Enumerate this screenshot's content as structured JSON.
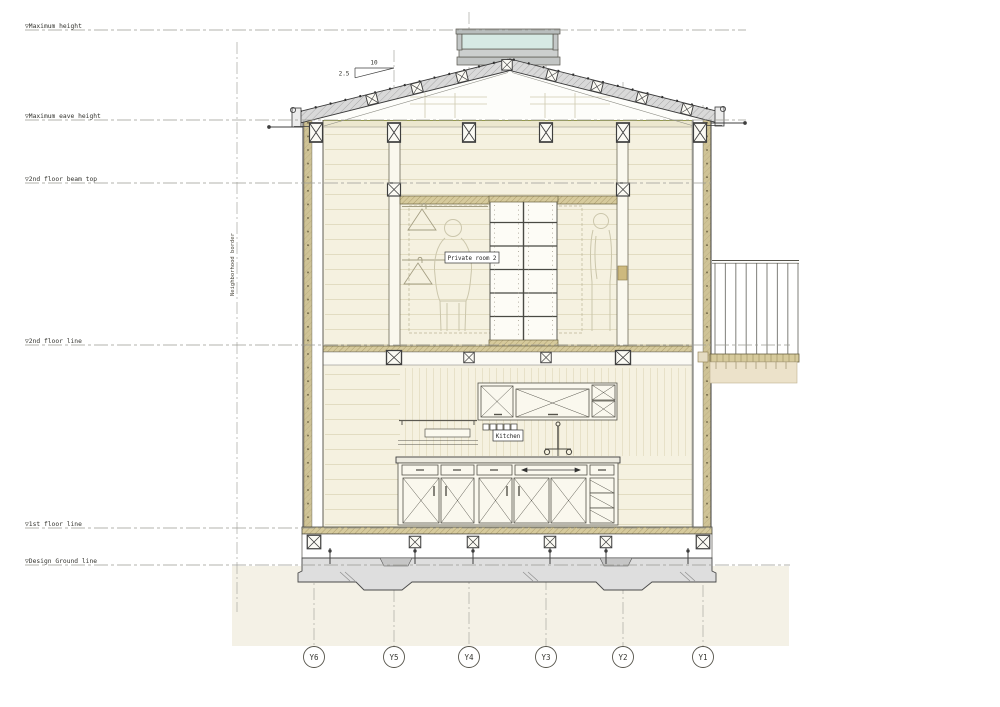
{
  "drawing": {
    "title": "Building cross section drawing",
    "datums": [
      {
        "label": "▽Maximum height"
      },
      {
        "label": "▽Maximum eave height"
      },
      {
        "label": "▽2nd floor beam top"
      },
      {
        "label": "▽2nd floor line"
      },
      {
        "label": "▽1st floor line"
      },
      {
        "label": "▽Design Ground line"
      }
    ],
    "grids": [
      {
        "label": "Y6"
      },
      {
        "label": "Y5"
      },
      {
        "label": "Y4"
      },
      {
        "label": "Y3"
      },
      {
        "label": "Y2"
      },
      {
        "label": "Y1"
      }
    ],
    "rooms": {
      "private_room": "Private room 2",
      "kitchen": "Kitchen"
    },
    "slope": {
      "run": "10",
      "rise": "2.5"
    },
    "boundary": {
      "label": "Neighborhood border"
    },
    "colors": {
      "interior_wall": "#f5f1e0",
      "exterior_cladding": "#cfc396",
      "wood_band": "#d6ca9c",
      "roof_fill": "#d9d9d9",
      "skylight_glass": "#d6e9e4",
      "concrete": "#dedede",
      "ground": "#f4f1e6",
      "line": "#3f3f3f"
    }
  }
}
